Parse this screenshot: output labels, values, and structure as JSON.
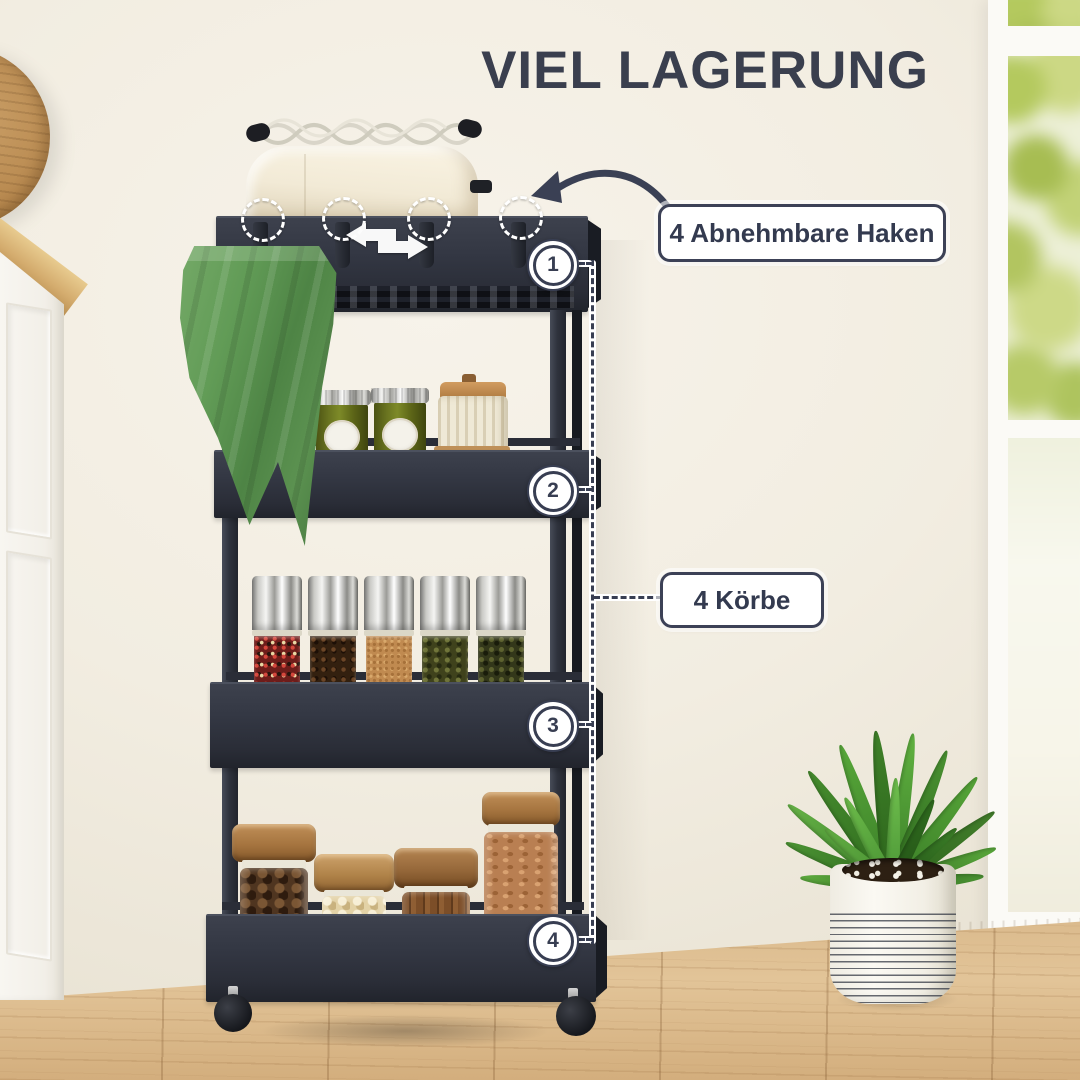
{
  "title": "VIEL LAGERUNG",
  "callouts": {
    "hooks": "4 Abnehmbare Haken",
    "baskets": "4 Körbe"
  },
  "tier_markers": [
    "1",
    "2",
    "3",
    "4"
  ],
  "icons": {
    "curved_arrow": "curved-arrow-icon",
    "slide_arrow": "slide-arrow-icon",
    "hook_highlight": "dashed-circle-icon"
  },
  "colors": {
    "accent_navy": "#383e52",
    "cart_black": "#2f333d",
    "towel_green": "#5b9150",
    "wall_cream": "#f2ede1",
    "floor_wood": "#dcbd91",
    "plant_green": "#55953c",
    "label_bg": "#ffffff"
  }
}
